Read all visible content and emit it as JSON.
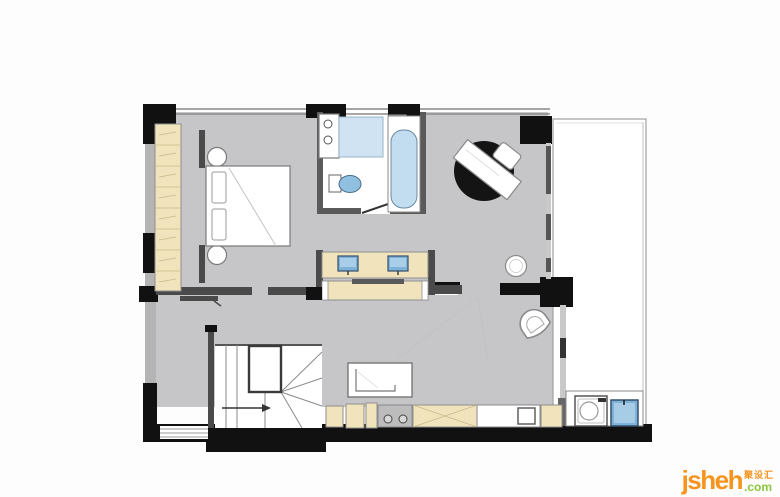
{
  "watermark": {
    "brand": "jsheh",
    "tld": ".com",
    "cjk_label": "聚设汇"
  },
  "palette": {
    "floor_gray": "#c6c6c8",
    "wall_dark": "#4a4a4a",
    "wall_black": "#111111",
    "cabinet_tan": "#f1e3bb",
    "fixture_blue": "#a9cfe8",
    "glass_blue": "#cfe3f2",
    "brand_orange": "#f7941e",
    "brand_green": "#8cc63e"
  }
}
